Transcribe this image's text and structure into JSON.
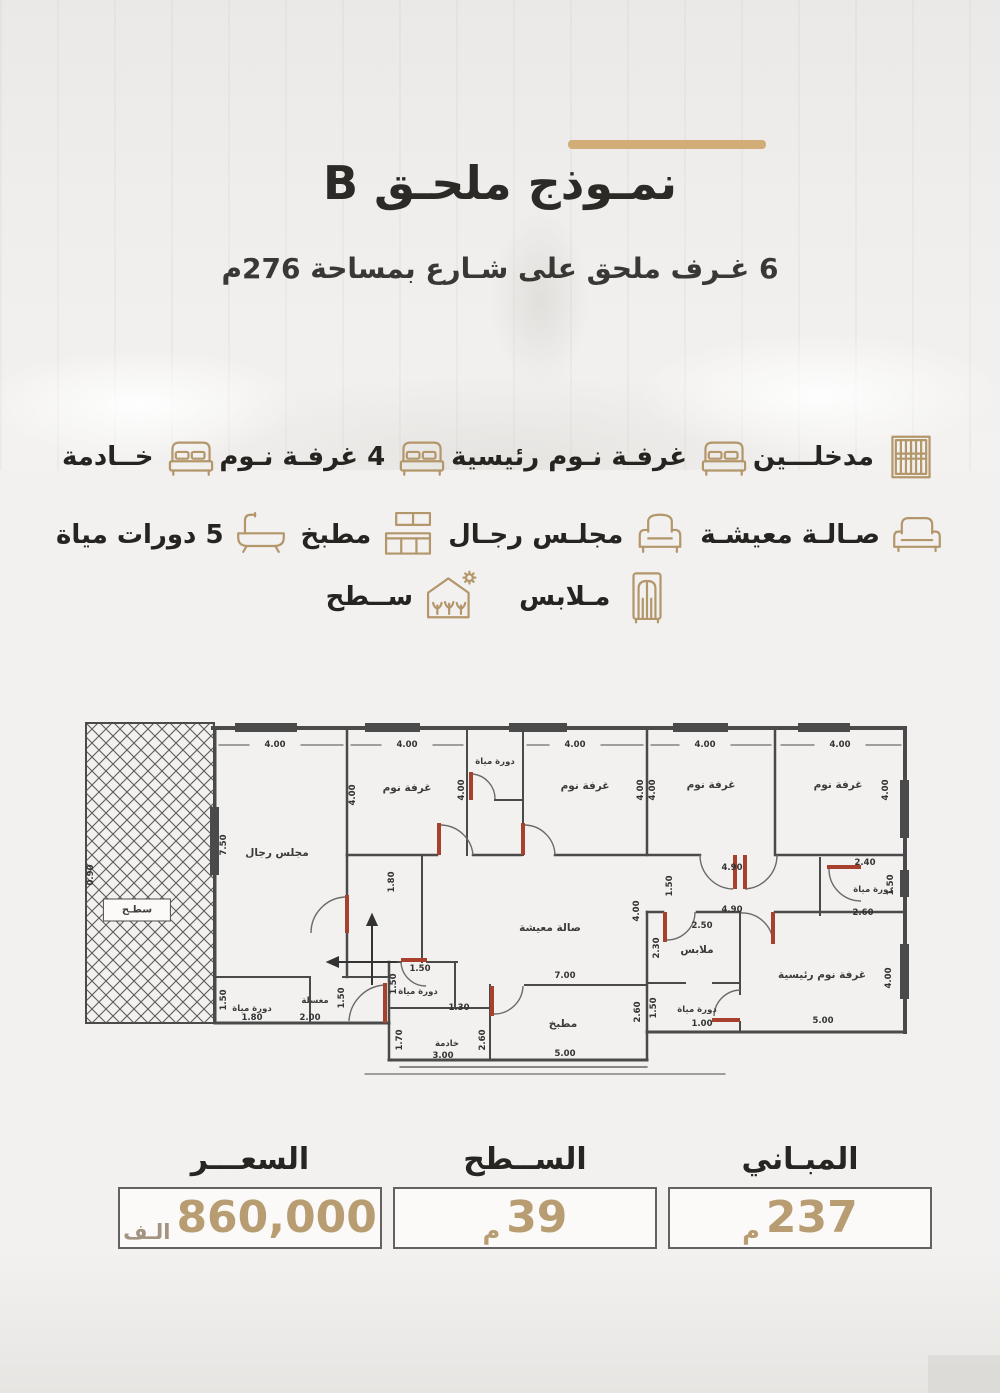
{
  "page": {
    "accent": "#b3966a",
    "divider_color": "#d2ad77",
    "text_dark": "#2b2a27"
  },
  "header": {
    "title": "نمـوذج ملحـق B",
    "subtitle": "6 غـرف ملحق على شـارع بمساحة 276م"
  },
  "features": {
    "rows": [
      {
        "items": [
          {
            "icon": "door-icon",
            "label": "مدخلـــين"
          },
          {
            "icon": "bed-icon",
            "label": "غرفـة نـوم رئيسية"
          },
          {
            "icon": "bed-icon",
            "label": "4 غرفـة نـوم"
          },
          {
            "icon": "bed-icon",
            "label": "خــادمة"
          }
        ]
      },
      {
        "items": [
          {
            "icon": "sofa-icon",
            "label": "صـالـة معيشـة"
          },
          {
            "icon": "armchair-icon",
            "label": "مجلـس رجـال"
          },
          {
            "icon": "kitchen-icon",
            "label": "مطبخ"
          },
          {
            "icon": "bathtub-icon",
            "label": "5 دورات مياة"
          }
        ]
      },
      {
        "items": [
          {
            "icon": "wardrobe-icon",
            "label": "مـلابس"
          },
          {
            "icon": "roof-icon",
            "label": "ســطح"
          }
        ]
      }
    ]
  },
  "floor_plan": {
    "rooms": [
      {
        "t": "سطـح",
        "x": 52,
        "y": 188,
        "boxed": true
      },
      {
        "t": "مجلس رجال",
        "x": 192,
        "y": 131
      },
      {
        "t": "غرفة نوم",
        "x": 322,
        "y": 66
      },
      {
        "t": "غرفة نوم",
        "x": 500,
        "y": 64
      },
      {
        "t": "غرفة نوم",
        "x": 626,
        "y": 63
      },
      {
        "t": "غرفة نوم",
        "x": 753,
        "y": 63
      },
      {
        "t": "دورة مياة",
        "x": 410,
        "y": 40,
        "s": 1
      },
      {
        "t": "صالة معيشة",
        "x": 465,
        "y": 206
      },
      {
        "t": "دورة مياة",
        "x": 788,
        "y": 168,
        "s": 1
      },
      {
        "t": "ملابس",
        "x": 612,
        "y": 228
      },
      {
        "t": "غرفة نوم رئيسية",
        "x": 737,
        "y": 253
      },
      {
        "t": "دورة مياة",
        "x": 612,
        "y": 288,
        "s": 1
      },
      {
        "t": "مطبخ",
        "x": 478,
        "y": 302
      },
      {
        "t": "خادمة",
        "x": 362,
        "y": 322,
        "s": 1
      },
      {
        "t": "دورة مياة",
        "x": 333,
        "y": 270,
        "s": 1
      },
      {
        "t": "مغسلة",
        "x": 230,
        "y": 279,
        "s": 1
      },
      {
        "t": "دورة مياة",
        "x": 167,
        "y": 287,
        "s": 1
      }
    ],
    "dims": [
      {
        "t": "4.00",
        "x": 190,
        "y": 23
      },
      {
        "t": "4.00",
        "x": 322,
        "y": 23
      },
      {
        "t": "4.00",
        "x": 490,
        "y": 23
      },
      {
        "t": "4.00",
        "x": 620,
        "y": 23
      },
      {
        "t": "4.00",
        "x": 755,
        "y": 23
      },
      {
        "t": "0.90",
        "x": 6,
        "y": 153,
        "rot": 1
      },
      {
        "t": "7.50",
        "x": 139,
        "y": 123,
        "rot": 1
      },
      {
        "t": "4.00",
        "x": 268,
        "y": 73,
        "rot": 1
      },
      {
        "t": "4.00",
        "x": 377,
        "y": 68,
        "rot": 1
      },
      {
        "t": "4.00",
        "x": 556,
        "y": 68,
        "rot": 1
      },
      {
        "t": "4.00",
        "x": 568,
        "y": 68,
        "rot": 1
      },
      {
        "t": "4.00",
        "x": 801,
        "y": 68,
        "rot": 1
      },
      {
        "t": "1.80",
        "x": 307,
        "y": 160,
        "rot": 1
      },
      {
        "t": "1.50",
        "x": 585,
        "y": 164,
        "rot": 1
      },
      {
        "t": "4.00",
        "x": 552,
        "y": 189,
        "rot": 1
      },
      {
        "t": "4.90",
        "x": 647,
        "y": 146
      },
      {
        "t": "4.90",
        "x": 647,
        "y": 188
      },
      {
        "t": "2.40",
        "x": 780,
        "y": 141
      },
      {
        "t": "2.60",
        "x": 778,
        "y": 191
      },
      {
        "t": "1.50",
        "x": 806,
        "y": 163,
        "rot": 1
      },
      {
        "t": "2.50",
        "x": 617,
        "y": 204
      },
      {
        "t": "2.30",
        "x": 572,
        "y": 226,
        "rot": 1
      },
      {
        "t": "4.00",
        "x": 804,
        "y": 256,
        "rot": 1
      },
      {
        "t": "5.00",
        "x": 738,
        "y": 299
      },
      {
        "t": "1.50",
        "x": 569,
        "y": 286,
        "rot": 1
      },
      {
        "t": "1.00",
        "x": 617,
        "y": 302
      },
      {
        "t": "2.60",
        "x": 553,
        "y": 290,
        "rot": 1
      },
      {
        "t": "7.00",
        "x": 480,
        "y": 254
      },
      {
        "t": "5.00",
        "x": 480,
        "y": 332
      },
      {
        "t": "3.00",
        "x": 358,
        "y": 334
      },
      {
        "t": "2.60",
        "x": 398,
        "y": 318,
        "rot": 1
      },
      {
        "t": "1.70",
        "x": 315,
        "y": 318,
        "rot": 1
      },
      {
        "t": "1.50",
        "x": 335,
        "y": 247
      },
      {
        "t": "1.50",
        "x": 309,
        "y": 262,
        "rot": 1
      },
      {
        "t": "1.30",
        "x": 374,
        "y": 286
      },
      {
        "t": "1.80",
        "x": 167,
        "y": 296
      },
      {
        "t": "2.00",
        "x": 225,
        "y": 296
      },
      {
        "t": "1.50",
        "x": 139,
        "y": 278,
        "rot": 1
      },
      {
        "t": "1.50",
        "x": 257,
        "y": 276,
        "rot": 1
      }
    ]
  },
  "summary": {
    "items": [
      {
        "label": "المبـاني",
        "value": "237",
        "unit": "م"
      },
      {
        "label": "الســطح",
        "value": "39",
        "unit": "م"
      },
      {
        "label": "السعـــر",
        "value": "860,000",
        "unit": "الـف"
      }
    ]
  }
}
